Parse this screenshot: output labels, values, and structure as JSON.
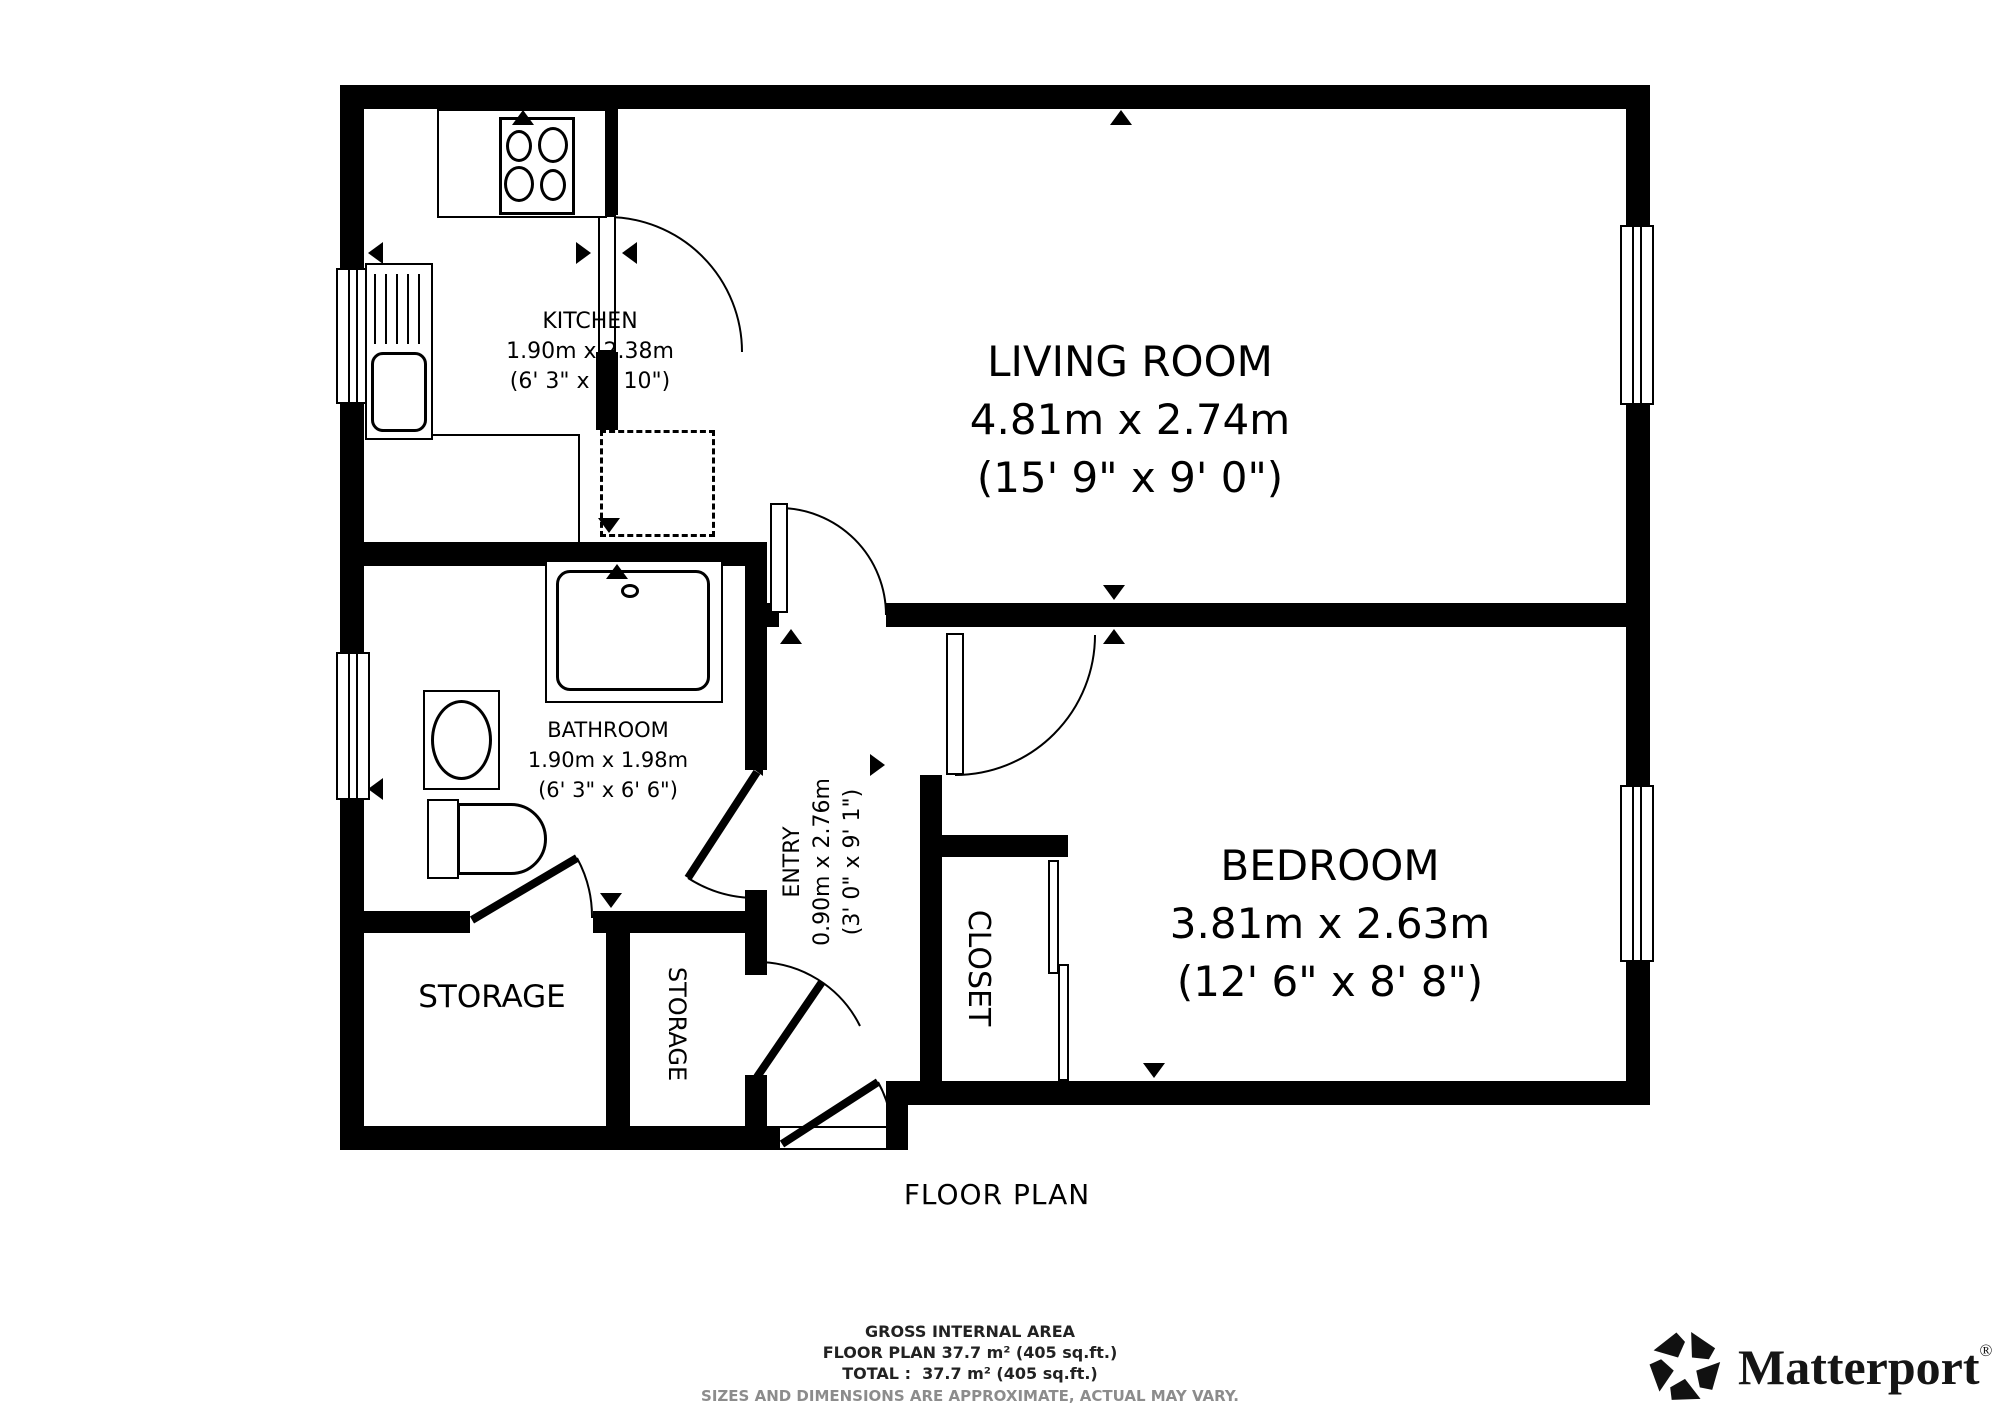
{
  "caption": {
    "title": "FLOOR PLAN"
  },
  "rooms": {
    "kitchen": {
      "name": "KITCHEN",
      "metric": "1.90m x 2.38m",
      "imperial": "(6' 3\" x 7' 10\")"
    },
    "living_room": {
      "name": "LIVING ROOM",
      "metric": "4.81m x 2.74m",
      "imperial": "(15' 9\" x 9' 0\")"
    },
    "bathroom": {
      "name": "BATHROOM",
      "metric": "1.90m x 1.98m",
      "imperial": "(6' 3\" x 6' 6\")"
    },
    "entry": {
      "name": "ENTRY",
      "metric": "0.90m x 2.76m",
      "imperial": "(3' 0\" x 9' 1\")"
    },
    "bedroom": {
      "name": "BEDROOM",
      "metric": "3.81m x 2.63m",
      "imperial": "(12' 6\" x 8' 8\")"
    },
    "closet": {
      "name": "CLOSET"
    },
    "storage_large": {
      "name": "STORAGE"
    },
    "storage_small": {
      "name": "STORAGE"
    }
  },
  "footer": {
    "area_title": "GROSS INTERNAL AREA",
    "floor_plan_area": "FLOOR PLAN 37.7 m² (405 sq.ft.)",
    "total_area": "TOTAL :  37.7 m² (405 sq.ft.)",
    "disclaimer": "SIZES AND DIMENSIONS ARE APPROXIMATE, ACTUAL MAY VARY."
  },
  "branding": {
    "logo_text": "Matterport",
    "registered": "®"
  },
  "colors": {
    "wall": "#000000",
    "background": "#ffffff",
    "disclaimer_text": "#8c8c8c"
  }
}
